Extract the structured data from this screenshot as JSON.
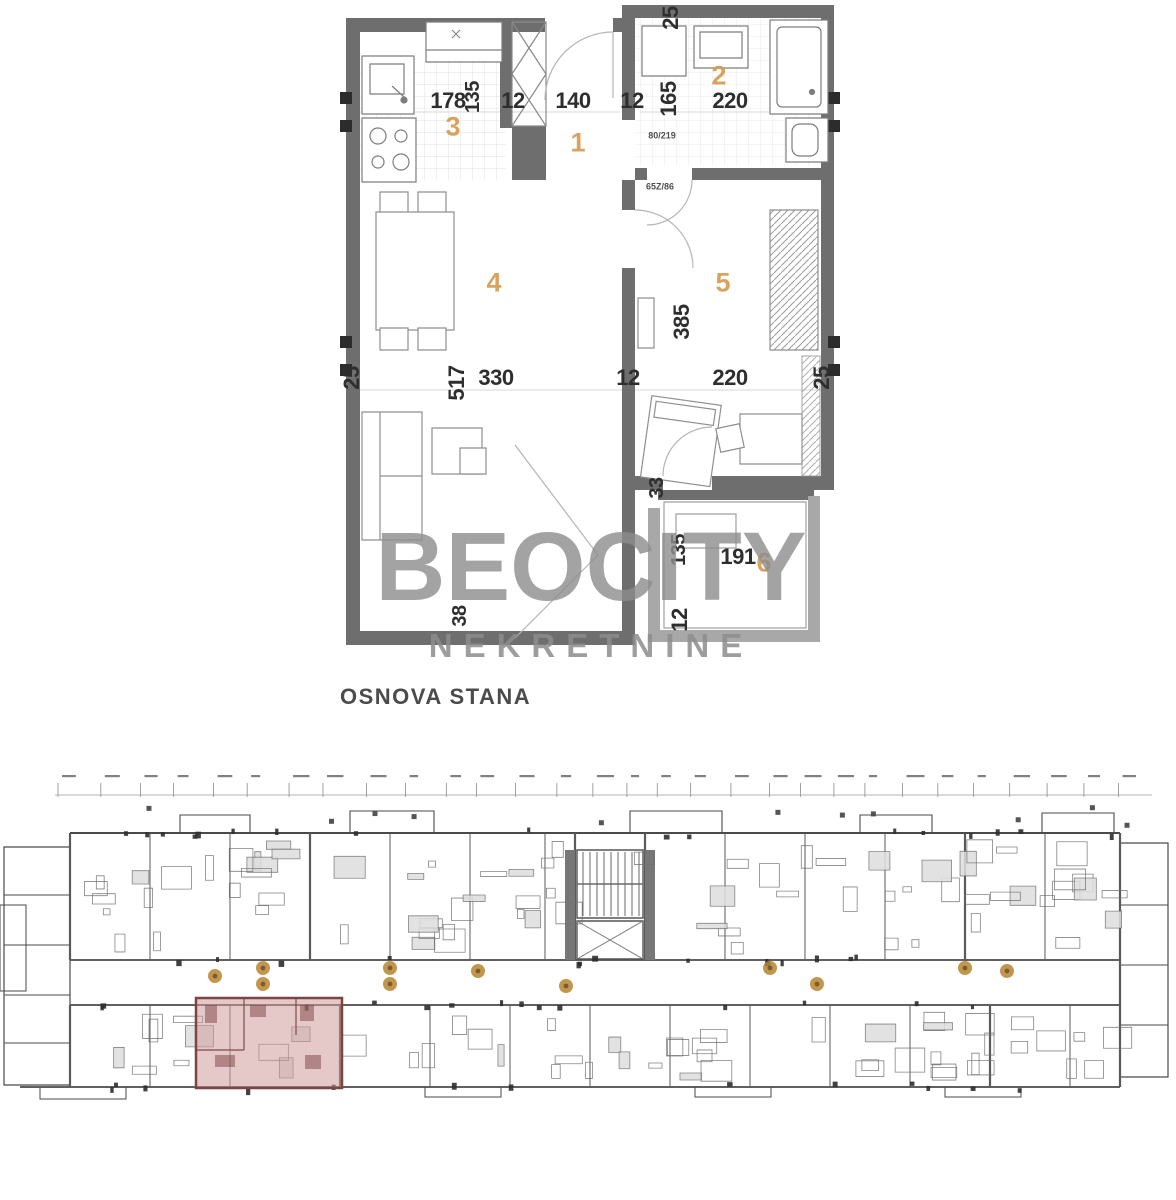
{
  "title": "OSNOVA STANA",
  "watermark": {
    "line1": "BEOCITY",
    "line2": "NEKRETNINE"
  },
  "colors": {
    "wall": "#6e6e6e",
    "wall-light": "#a8a8a8",
    "dim-text": "#2e2e2e",
    "room-number": "#d49a4e",
    "watermark": "#8d8d8d",
    "title-text": "#4b4b4b",
    "highlight-fill": "#cf9d9d",
    "highlight-wall": "#7e4343",
    "badge": "#b8852e",
    "plan-line": "#4a4a4a"
  },
  "unit_plan": {
    "room_labels": [
      {
        "number": "1"
      },
      {
        "number": "2"
      },
      {
        "number": "3"
      },
      {
        "number": "4"
      },
      {
        "number": "5"
      },
      {
        "number": "6"
      }
    ],
    "dimensions": [
      {
        "text": "178"
      },
      {
        "text": "135"
      },
      {
        "text": "12"
      },
      {
        "text": "140"
      },
      {
        "text": "12"
      },
      {
        "text": "165"
      },
      {
        "text": "220"
      },
      {
        "text": "25"
      },
      {
        "text": "25"
      },
      {
        "text": "517"
      },
      {
        "text": "330"
      },
      {
        "text": "12"
      },
      {
        "text": "220"
      },
      {
        "text": "25"
      },
      {
        "text": "385"
      },
      {
        "text": "33"
      },
      {
        "text": "135"
      },
      {
        "text": "191"
      },
      {
        "text": "12"
      },
      {
        "text": "38"
      }
    ],
    "door_labels": [
      {
        "text": "80/219"
      },
      {
        "text": "65Z/86"
      }
    ]
  }
}
